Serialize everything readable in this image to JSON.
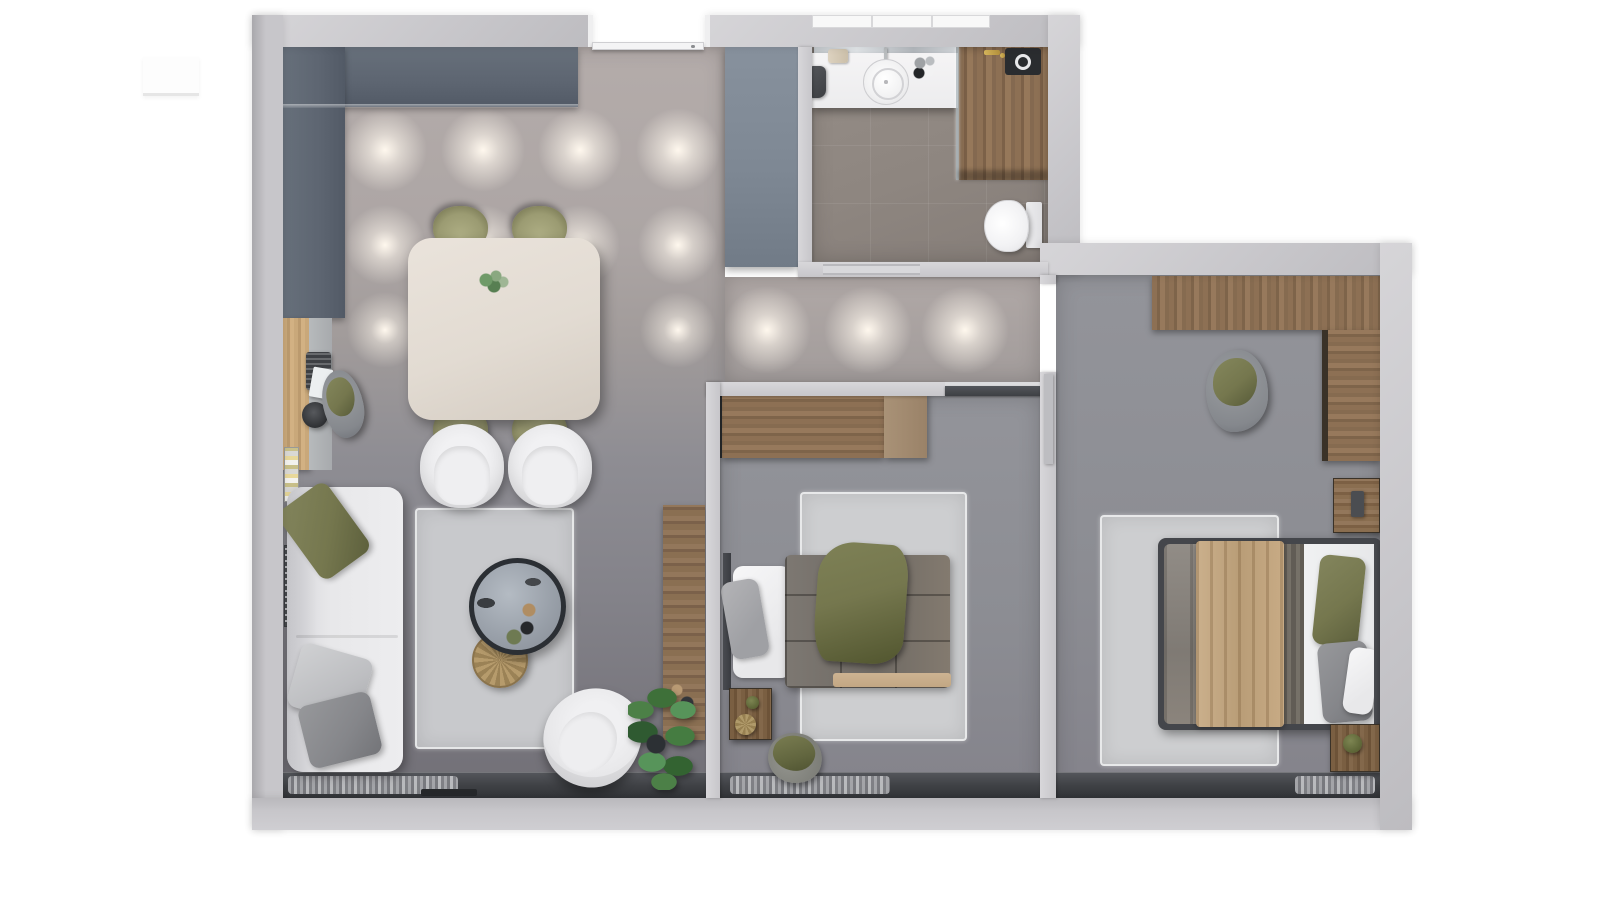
{
  "scene": {
    "type": "3d-floorplan-top-down-render",
    "title": "Two-bedroom apartment floor plan — photorealistic top view",
    "background": "#ffffff",
    "text_visible": "none"
  },
  "colors": {
    "background": "#ffffff",
    "wall": "#c7c6ca",
    "wallEdge": "#a9a8ac",
    "wallInner": "#d6d5d8",
    "floorWarm": "#b4acaa",
    "floorWarmDeep": "#a29c9b",
    "floorCool": "#8e8d93",
    "floorCoolDeep": "#716f76",
    "floorBedroom": "#93949a",
    "floorBedroomDeep": "#84838b",
    "floorBath": "#8e8680",
    "counter": "#5d6571",
    "panel": "#7e8894",
    "wood": "#8d7054",
    "oak": "#c9a87a",
    "sofa": "#e8e8ea",
    "rug": "#cdced0",
    "olive": "#75774e",
    "oliveDeep": "#5c5f3c",
    "tan": "#c2a783",
    "duvet": "#6f6a64",
    "bedFrame": "#44464b",
    "tableCream": "#e2dbd2",
    "chairOlive": "#9b9b72",
    "tableTop": "#9aa1aa",
    "tableRim": "#2b2f34",
    "rattan": "#b69b6c",
    "windowBand": "#3e4044",
    "curtain": "#aeafb3",
    "glow": "#fff8ee",
    "plant": "#4c8047",
    "plantDeep": "#2f5a31"
  },
  "rooms": [
    {
      "id": "living-dining-kitchen",
      "name": "Open living / dining / kitchen",
      "furniture": [
        "L-shaped dark slate kitchen counter",
        "cream dining table with plant centerpiece",
        "4 olive dining chairs",
        "wall desk with laptop, paper and stool",
        "gray bean bag with olive blanket",
        "magazine rack",
        "white two-seat sofa with olive and gray pillows",
        "2 white armchairs",
        "light gray area rug",
        "round coffee table with decor",
        "rattan pouf",
        "white swivel lounge chair",
        "monstera plant",
        "tall wooden console",
        "radiator",
        "window with sheer curtain",
        "ceiling spotlight grid"
      ]
    },
    {
      "id": "entry",
      "name": "Entry",
      "furniture": [
        "entrance door",
        "slate wardrobe panel",
        "ceiling spotlights"
      ]
    },
    {
      "id": "bathroom",
      "name": "Bathroom",
      "furniture": [
        "mirror strip",
        "white vanity with round vessel sink",
        "cosmetic bottles",
        "beige and dark towels",
        "wood laundry zone with glass divider",
        "washing machine",
        "gold fittings",
        "wall-hung toilet",
        "sliding pocket door",
        "top window"
      ]
    },
    {
      "id": "hallway",
      "name": "Hallway",
      "furniture": [
        "ceiling spotlights",
        "sliding door to bedroom 1",
        "hinged door to bedroom 2"
      ]
    },
    {
      "id": "bedroom-1",
      "name": "Bedroom 1",
      "furniture": [
        "wood wardrobe with dark end panel",
        "single bed with gridded gray duvet and olive throw",
        "white and gray pillows",
        "shag rug",
        "dark wood nightstand with plant and woven ball",
        "floor pouf with olive blanket",
        "window with curtain"
      ]
    },
    {
      "id": "bedroom-2",
      "name": "Bedroom 2",
      "furniture": [
        "L-shaped wood wardrobe",
        "bean bag with olive blanket",
        "wood nightstand with dark lamp",
        "double bed with tan runner and dark frame",
        "olive, gray and white pillows",
        "shag rug",
        "second nightstand with plant",
        "window with curtain"
      ]
    }
  ],
  "lighting": {
    "spot_grid_rows_px": [
      150,
      245,
      330
    ],
    "spot_columns_px": [
      385,
      483,
      580,
      678,
      767,
      868,
      965
    ]
  }
}
